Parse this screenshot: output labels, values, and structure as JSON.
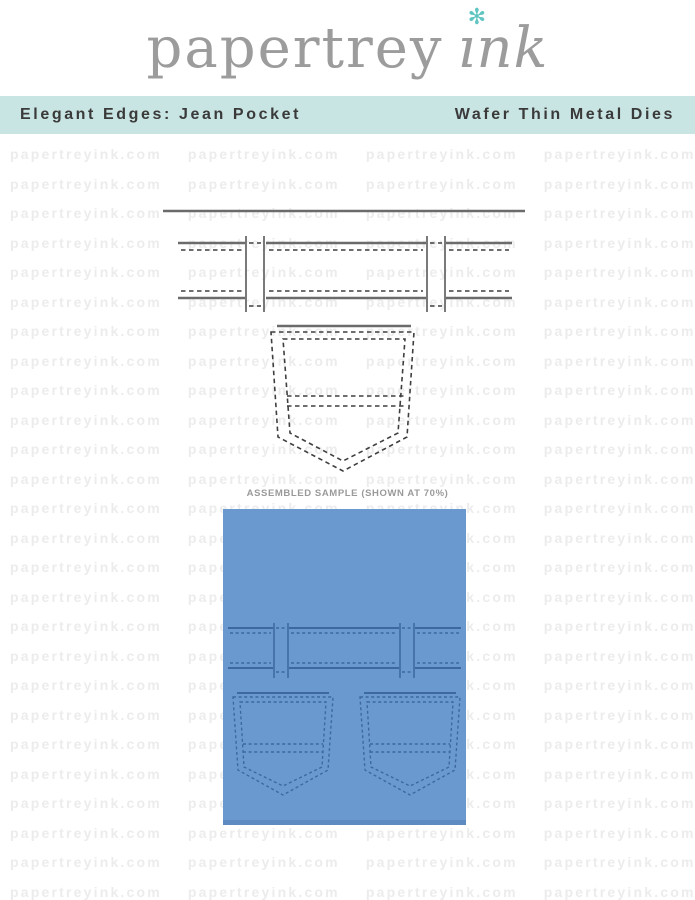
{
  "header": {
    "logo_text": "papertrey",
    "logo_suffix": "ınk",
    "flower_glyph": "✻"
  },
  "banner": {
    "title": "Elegant Edges: Jean Pocket",
    "subtitle": "Wafer Thin Metal Dies"
  },
  "watermark": {
    "text": "papertreyink.com",
    "repeats_per_row": 4,
    "rows": 26
  },
  "sample": {
    "caption": "ASSEMBLED SAMPLE (SHOWN AT 70%)"
  },
  "colors": {
    "banner-bg": "#c9e5e3",
    "banner-text": "#3a3a3a",
    "logo-gray": "#9c9c9c",
    "accent-teal": "#5fc5c1",
    "watermark-gray": "#ececec",
    "caption-gray": "#9a9a9a",
    "die-solid": "#6b6b6b",
    "die-dash": "#3f3f3f",
    "card-blue": "#6a99d0",
    "card-edge": "#5d8ac0",
    "card-stitch": "#3d69a0"
  }
}
